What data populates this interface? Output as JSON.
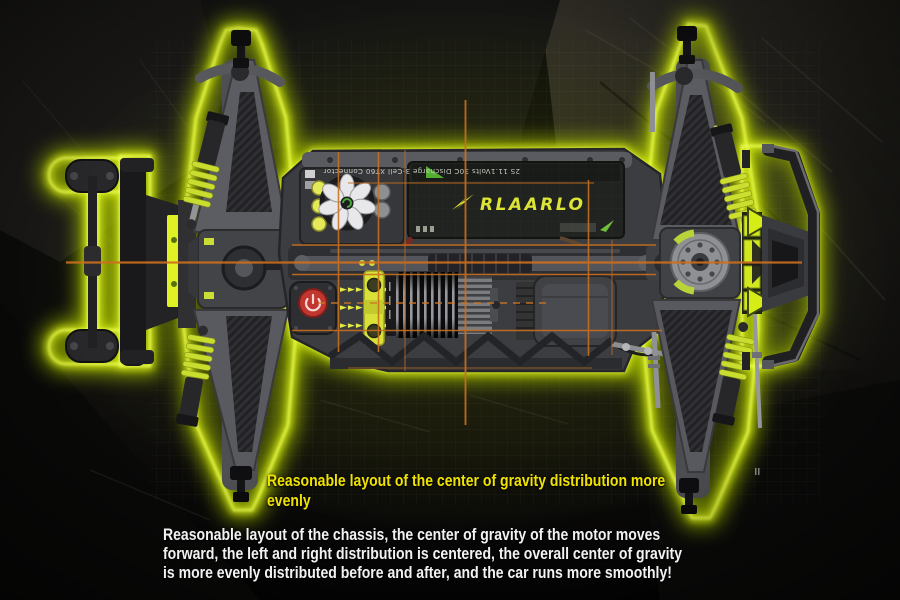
{
  "meta": {
    "alt": "Top view of an RLAARLO RC car chassis glowing neon green on dark rock, with orange center-of-gravity crosshair overlay"
  },
  "colors": {
    "background": "#0c0c0b",
    "neon_glow": "#d6ee15",
    "crosshair_orange": "#c9701f",
    "heading_yellow": "#f0e300",
    "paragraph_white": "#f2f2f2",
    "accent_yellow": "#d9e139",
    "power_button_red": "#c23630",
    "brand_yellow": "#dde435"
  },
  "heading": {
    "lines": [
      "Reasonable layout of the center of gravity distribution more",
      "evenly"
    ]
  },
  "paragraph": {
    "lines": [
      "Reasonable layout of the chassis, the center of gravity of the motor moves",
      "forward, the left and right distribution is centered, the overall center of gravity",
      "is more evenly distributed before and after, and the car runs more smoothly!"
    ]
  },
  "battery": {
    "brand": "RLAARLO",
    "spec": "2S 11.1Volts 30C Discharge 3-Cell XT60 Connector"
  },
  "markers": {
    "arrows": "►►► ►►►"
  }
}
